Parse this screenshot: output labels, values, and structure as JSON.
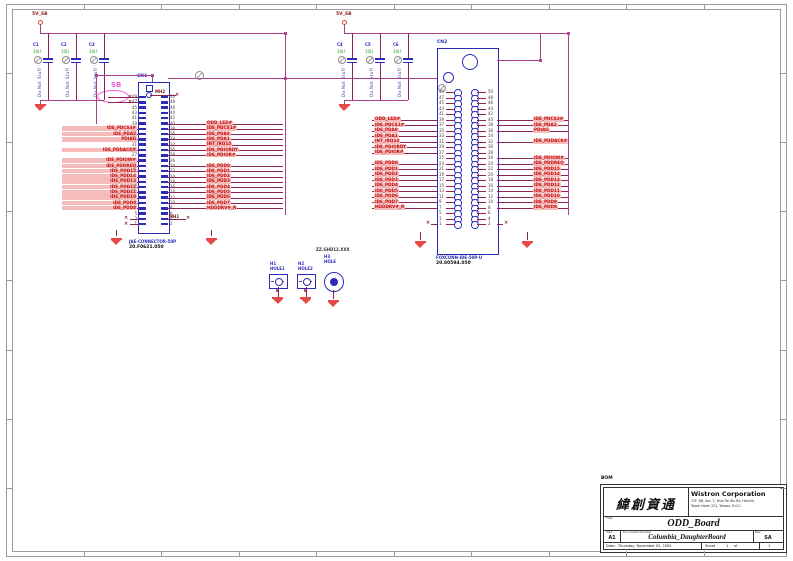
{
  "colors": {
    "bus_wire": "#a8418a",
    "signal_wire": "#8a2557",
    "connector_blue": "#2b2bb8",
    "net_label_text": "#c31010",
    "net_label_bg": "#f6bcbc",
    "ground_red": "#e84848",
    "value_green": "#1d9c1d",
    "bus_bubble_pink": "#ef5fd2"
  },
  "power_left": {
    "net": "5V_SB",
    "caps": [
      {
        "ref": "C1",
        "value": "10U",
        "note": "Do Not Stuff"
      },
      {
        "ref": "C2",
        "value": "10U",
        "note": "Do Not Stuff"
      },
      {
        "ref": "C3",
        "value": "10U",
        "note": "Do Not Stuff"
      }
    ]
  },
  "power_right": {
    "net": "5V_SB",
    "caps": [
      {
        "ref": "C4",
        "value": "10U",
        "note": "Do Not Stuff"
      },
      {
        "ref": "C5",
        "value": "10U",
        "note": "Do Not Stuff"
      },
      {
        "ref": "C6",
        "value": "10U",
        "note": "Do Not Stuff"
      }
    ]
  },
  "cn1": {
    "ref": "CN1",
    "pin_count": 50,
    "mh_top": "MH2",
    "mh_bottom": "MH1",
    "part_name": "JAE-CONNECTOR-50P",
    "part_number": "20.F0621.050",
    "left_groups": [
      [
        "IDE_PDCS3#",
        "IDE_PDA2",
        "PDIAG"
      ],
      [
        "IDE_PDDACK#"
      ],
      [
        "IDE_PDIOW#",
        "IDE_PDDREQ",
        "IDE_PDD15",
        "IDE_PDD14",
        "IDE_PDD13",
        "IDE_PDD12",
        "IDE_PDD11",
        "IDE_PDD10",
        "IDE_PDD9",
        "IDE_PDD8"
      ]
    ],
    "right_groups": [
      [
        "ODD_LED#",
        "IDE_PDCS1#",
        "IDE_PDA0",
        "IDE_PDA1",
        "INT_IRQ14",
        "IDE_PDIORDY",
        "IDE_PDIOR#"
      ],
      [
        "IDE_PDD0",
        "IDE_PDD1",
        "IDE_PDD2",
        "IDE_PDD3",
        "IDE_PDD4",
        "IDE_PDD5",
        "IDE_PDD6",
        "IDE_PDD7",
        "HDDDRV#_R"
      ]
    ]
  },
  "cn2": {
    "ref": "CN2",
    "pin_count": 50,
    "part_name": "FOXCONN-IDE-50P-U",
    "part_number": "20.80594.050",
    "left_groups": [
      [
        "ODD_LED#",
        "IDE_PDCS1#",
        "IDE_PDA0",
        "IDE_PDA1",
        "INT_IRQ14",
        "IDE_PDIORDY",
        "IDE_PDIOR#"
      ],
      [
        "IDE_PDD0",
        "IDE_PDD1",
        "IDE_PDD2",
        "IDE_PDD3",
        "IDE_PDD4",
        "IDE_PDD5",
        "IDE_PDD6",
        "IDE_PDD7",
        "HDDDRV#_R"
      ]
    ],
    "right_groups": [
      [
        "IDE_PDCS3#",
        "IDE_PDA2",
        "PDIAG"
      ],
      [
        "IDE_PDDACK#"
      ],
      [
        "IDE_PDIOW#",
        "IDE_PDDREQ",
        "IDE_PDD15",
        "IDE_PDD14",
        "IDE_PDD13",
        "IDE_PDD12",
        "IDE_PDD11",
        "IDE_PDD10",
        "IDE_PDD9",
        "IDE_PDD8"
      ]
    ]
  },
  "bus_bubble": "SB",
  "holes": [
    {
      "ref": "H1",
      "label": "HOLE1"
    },
    {
      "ref": "H2",
      "label": "HOLE2"
    },
    {
      "ref": "H3",
      "label": "HOLE",
      "part": "ZZ.GHD12.XXX"
    }
  ],
  "title_block": {
    "bom": "BOM",
    "logo": "緯創資通",
    "company": "Wistron Corporation",
    "address_line1": "21F, 88, Sec. 1, Hsin Tai Wu Rd, Hsichih,",
    "address_line2": "Taipei Hsien 221, Taiwan, R.O.C.",
    "title_label": "Title",
    "board": "ODD_Board",
    "size_label": "Size",
    "size": "A1",
    "doc_label": "Document Number",
    "document": "Columbia_DaughterBoard",
    "rev_label": "Rev",
    "rev": "SA",
    "date_label": "Date:",
    "date": "Thursday, November 03, 2005",
    "sheet_label": "Sheet",
    "sheet_number": "1",
    "of_label": "of",
    "sheet_total": "1"
  }
}
